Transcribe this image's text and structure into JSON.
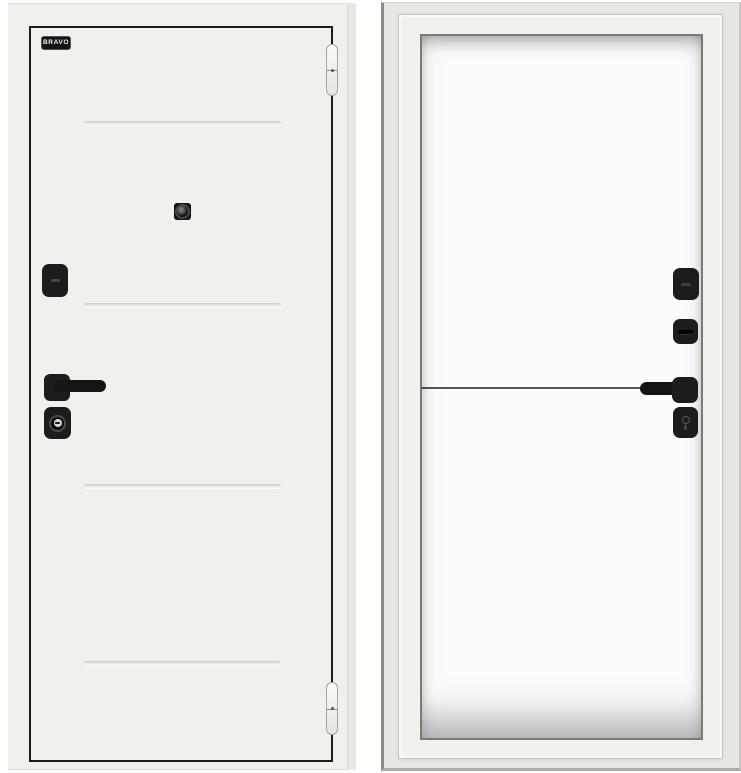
{
  "image": {
    "type": "product-photo",
    "subject": "white entry door, exterior leaf view and interior view in frame"
  },
  "brand": {
    "label": "BRAVO"
  },
  "panels": {
    "exterior": {
      "groove_count": 4,
      "hardware": [
        "peephole-icon",
        "lock-cover",
        "lever-handle",
        "key-cylinder",
        "hinge-top",
        "hinge-bottom"
      ]
    },
    "interior": {
      "hardware": [
        "lock-cover",
        "thumbturn",
        "lever-handle",
        "keyhole-escutcheon"
      ]
    }
  },
  "colors": {
    "bg": "#ffffff",
    "door-white": "#f1f0ec",
    "outline-black": "#1b1b1b",
    "hardware-black": "#1c1c1c",
    "frame-beige": "#e9e7e1",
    "leaf-white": "#fcfcfd",
    "groove-shadow": "#cbc9c3"
  }
}
